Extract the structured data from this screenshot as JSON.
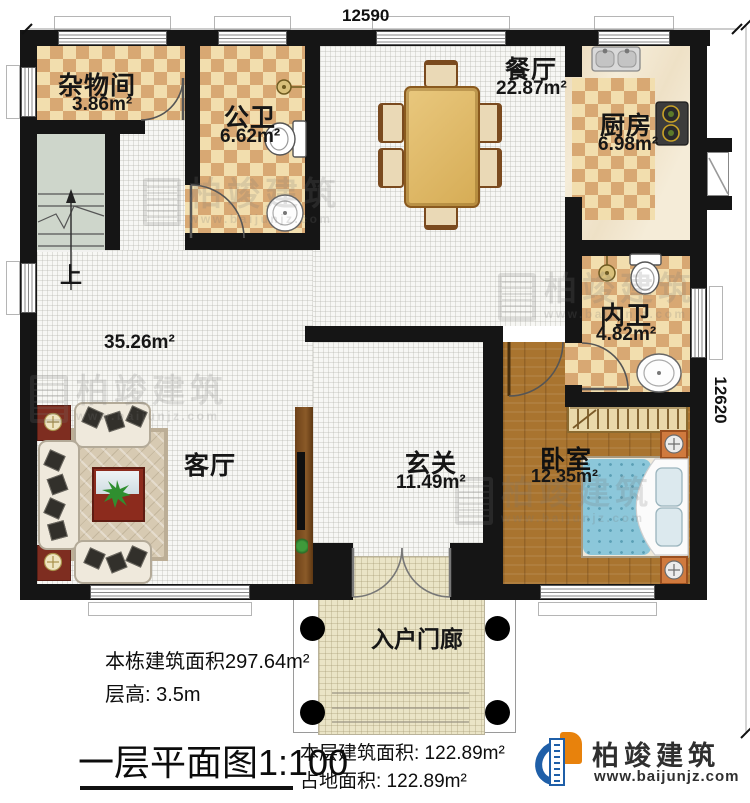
{
  "dimensions": {
    "top": "12590",
    "right": "12620"
  },
  "rooms": {
    "zawujian": {
      "name": "杂物间",
      "area": "3.86m²"
    },
    "gongwei": {
      "name": "公卫",
      "area": "6.62m²"
    },
    "canting": {
      "name": "餐厅",
      "area": "22.87m²"
    },
    "chufang": {
      "name": "厨房",
      "area": "6.98m²"
    },
    "neiwei": {
      "name": "内卫",
      "area": "4.82m²"
    },
    "xuanguan": {
      "name": "玄关",
      "area": "11.49m²"
    },
    "woshi": {
      "name": "卧室",
      "area": "12.35m²"
    },
    "keting": {
      "name": "客厅",
      "area": "35.26m²"
    },
    "porch": {
      "name": "入户门廊"
    }
  },
  "stairs": {
    "up_label": "上"
  },
  "info": {
    "building_area": "本栋建筑面积297.64m²",
    "floor_height": "层高:  3.5m",
    "plan_title": "一层平面图1:100",
    "floor_area": "本层建筑面积:  122.89m²",
    "footprint_area": "占地面积:  122.89m²"
  },
  "brand": {
    "name": "柏竣建筑",
    "url": "www.baijunjz.com"
  },
  "watermark": {
    "name": "柏竣建筑",
    "url": "www.baijunjz.com"
  }
}
